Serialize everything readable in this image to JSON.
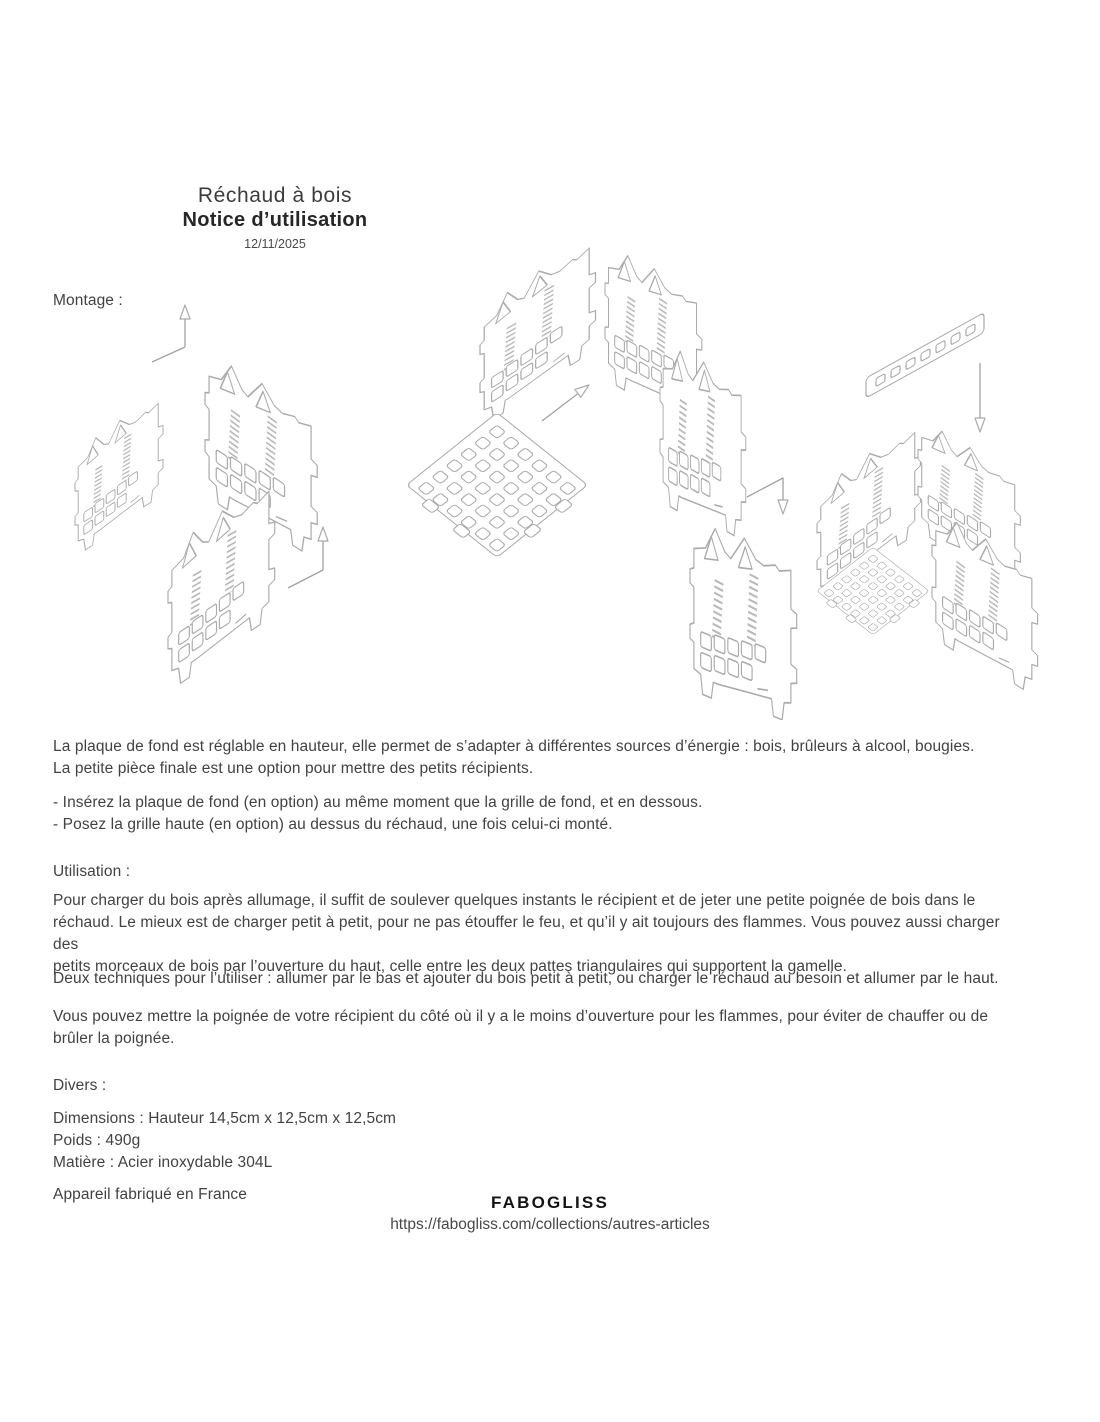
{
  "header": {
    "title": "Réchaud à bois",
    "subtitle": "Notice d’utilisation",
    "date": "12/11/2025"
  },
  "montage": {
    "label": "Montage :",
    "para1": [
      "La plaque de fond est réglable en hauteur, elle permet de s’adapter à différentes sources d’énergie : bois, brûleurs à alcool, bougies.",
      "La petite pièce finale est une option pour mettre des petits récipients."
    ],
    "bullets": [
      "- Insérez la plaque de fond (en option) au même moment que la grille de fond, et en dessous.",
      "- Posez la grille haute (en option) au dessus du réchaud, une fois celui-ci monté."
    ]
  },
  "utilisation": {
    "label": "Utilisation :",
    "para1": [
      "Pour charger du bois après allumage, il suffit de soulever quelques instants le récipient et de jeter une petite poignée de bois dans le",
      "réchaud. Le mieux est de charger petit à petit, pour ne pas étouffer le feu, et qu’il y ait toujours des flammes. Vous pouvez aussi charger des",
      "petits morceaux de bois par l’ouverture du haut, celle entre les deux pattes triangulaires qui supportent la gamelle."
    ],
    "para2": [
      "Deux techniques pour l’utiliser : allumer par le bas et ajouter du bois petit à petit, ou charger le réchaud au besoin et allumer par le haut."
    ],
    "para3": [
      "Vous pouvez mettre la poignée de votre récipient du côté où il y a le moins d’ouverture pour les flammes, pour éviter de chauffer ou de",
      "brûler la poignée."
    ]
  },
  "divers": {
    "label": "Divers :",
    "lines": [
      "Dimensions : Hauteur 14,5cm x 12,5cm x 12,5cm",
      "Poids : 490g",
      "Matière : Acier inoxydable 304L"
    ],
    "fabrication": "Appareil fabriqué en France"
  },
  "footer": {
    "brand": "FABOGLISS",
    "url": "https://fabogliss.com/collections/autres-articles"
  },
  "diagram": {
    "line_color": "#ababab",
    "parts": [
      "side-panel",
      "bottom-grid-plate",
      "u-assembly",
      "fourth-side-panel",
      "assembled-stove",
      "trivet-bar",
      "assembly-arrows"
    ]
  }
}
